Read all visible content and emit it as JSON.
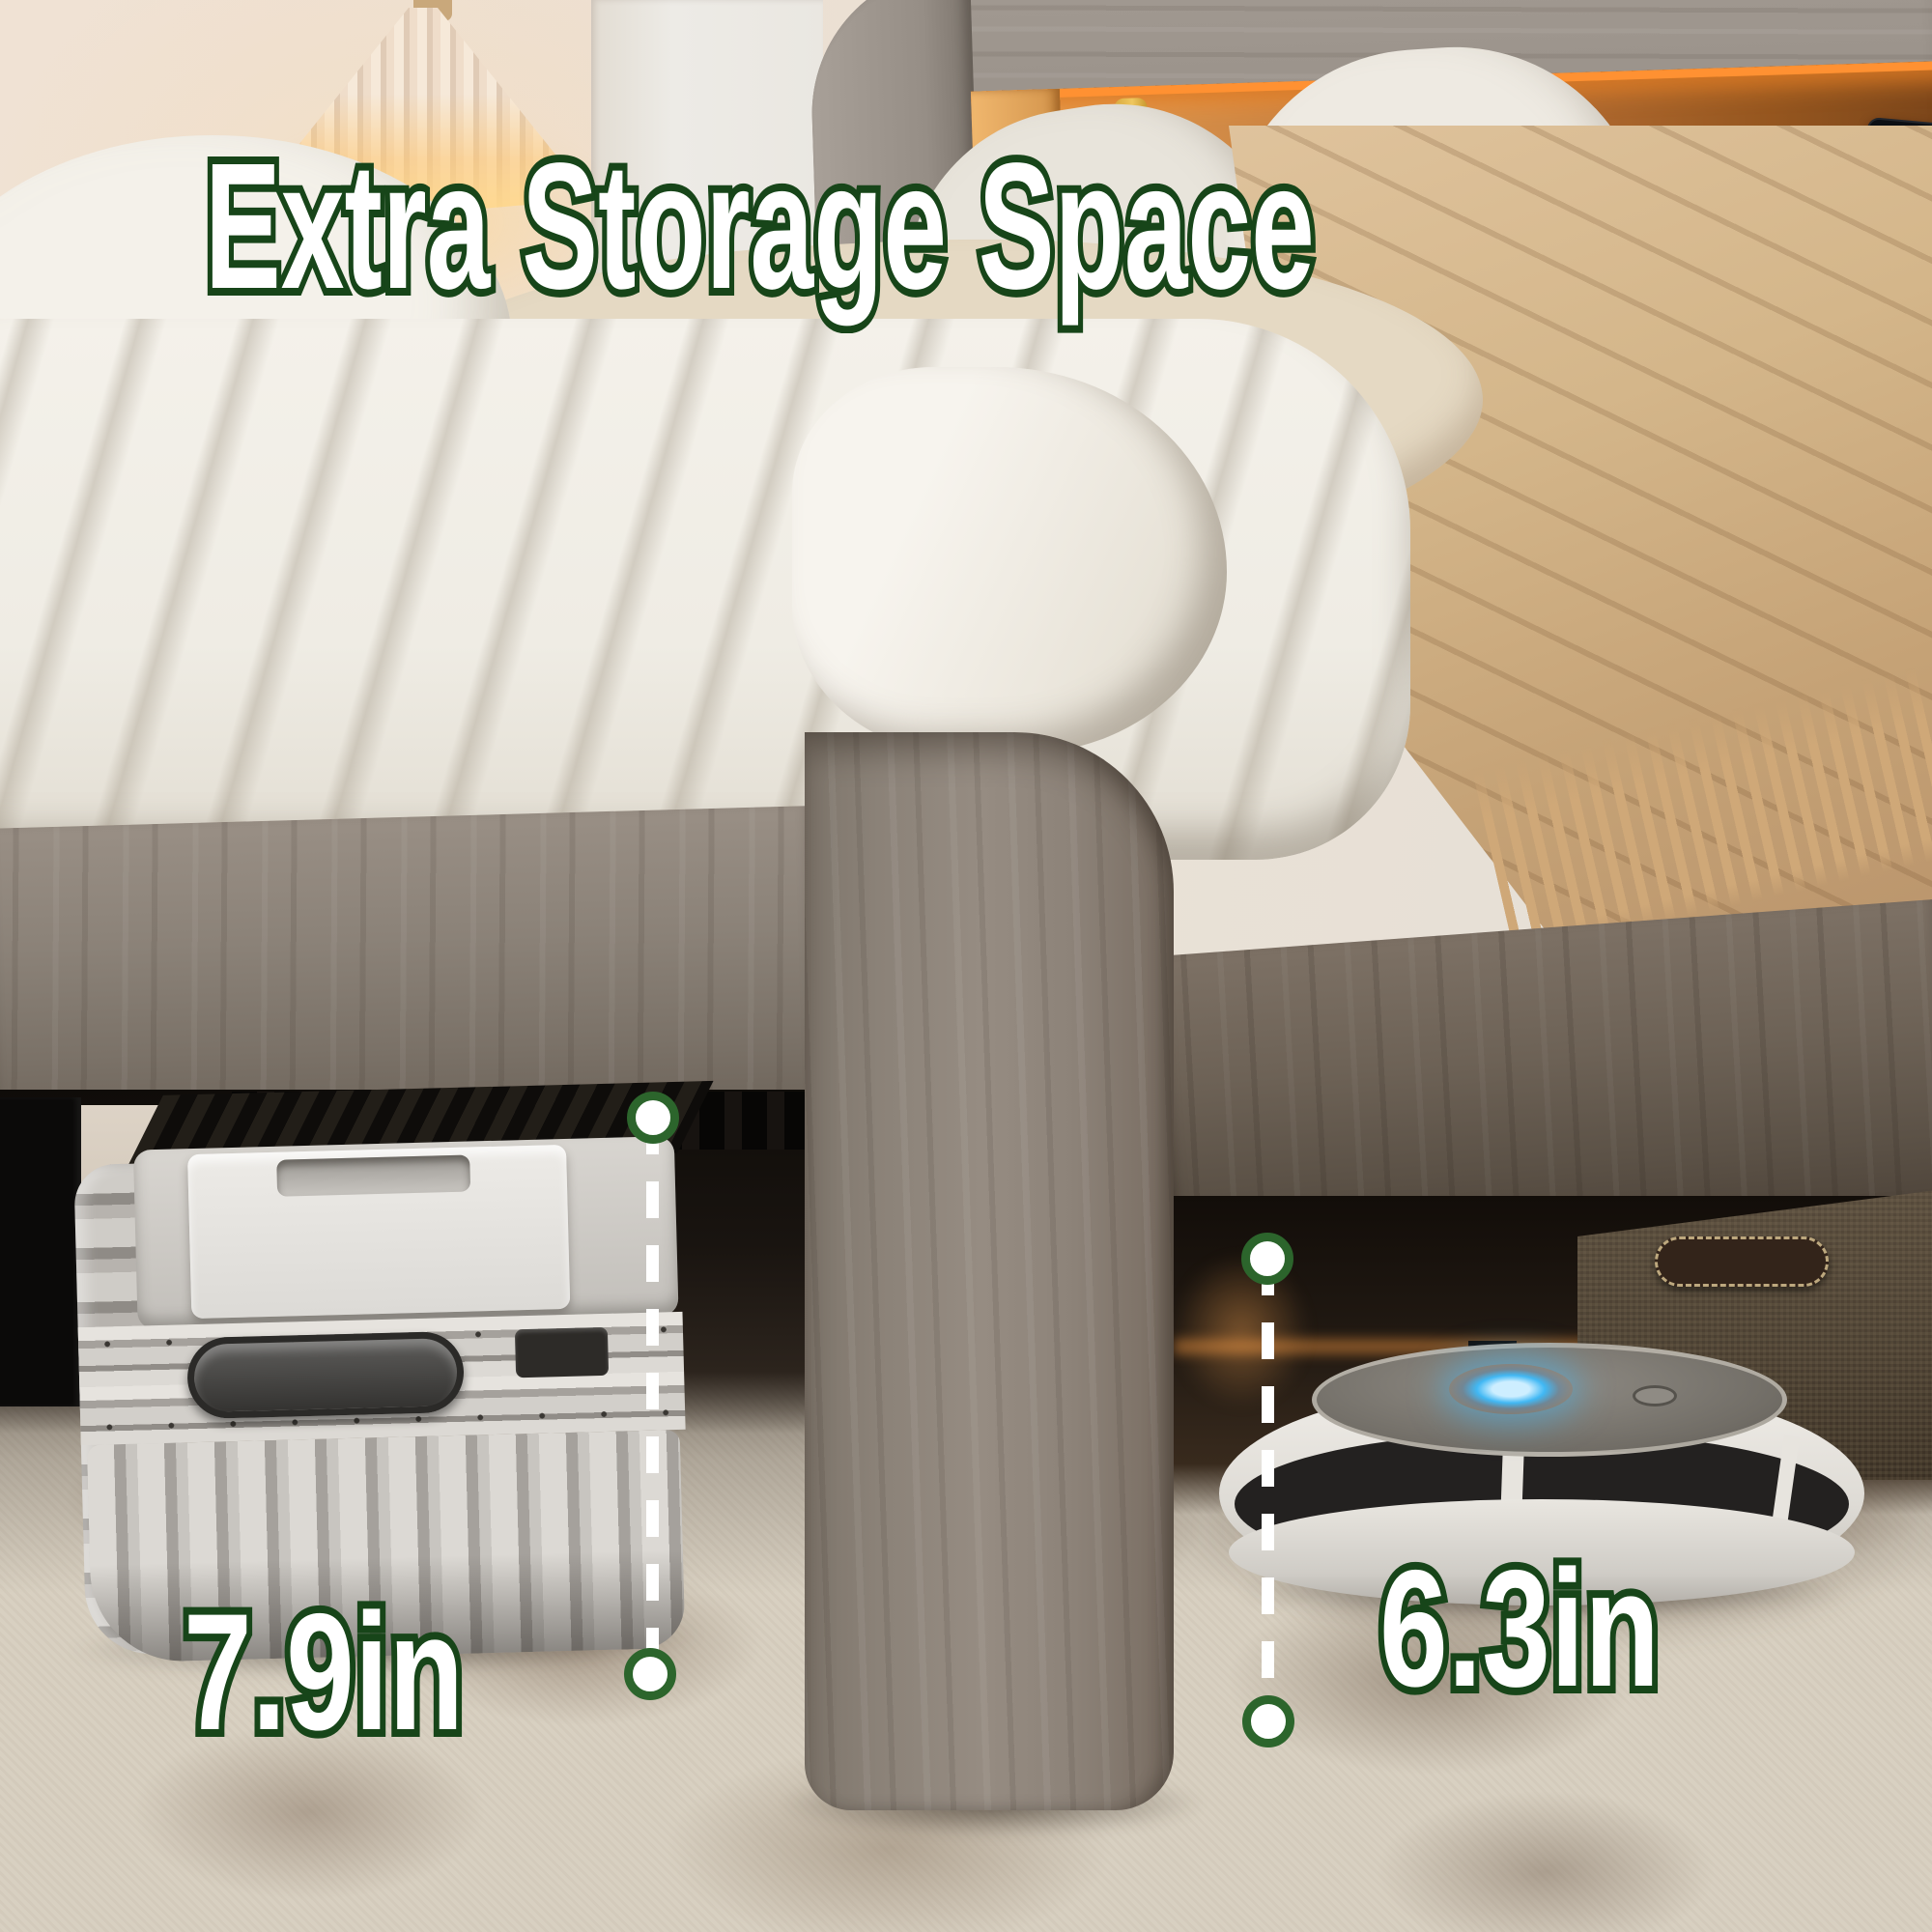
{
  "page": {
    "type": "product-feature-image",
    "subject": "bed frame with under-bed storage clearance"
  },
  "annotations": {
    "title": "Extra Storage Space",
    "left_measurement": {
      "value": "7.9in",
      "object_shown": "suitcase"
    },
    "right_measurement": {
      "value": "6.3in",
      "object_shown": "robot-vacuum"
    },
    "text_fill_color": "#ffffff",
    "text_outline_color": "#174519",
    "dashed_line_color": "#ffffff",
    "endpoint_dot_fill": "#ffffff",
    "endpoint_dot_ring_color": "#2c652c"
  },
  "headboard": {
    "led_strip_color": "#ff9132",
    "phone": {
      "status": "70% Charged",
      "charging_ring_color": "#2be0a0"
    }
  },
  "robot_vacuum": {
    "status_ring_color": "#41b8f4"
  },
  "icons": [
    "lightning-bolt-icon",
    "measure-endpoint-dot",
    "dashed-measure-line"
  ]
}
